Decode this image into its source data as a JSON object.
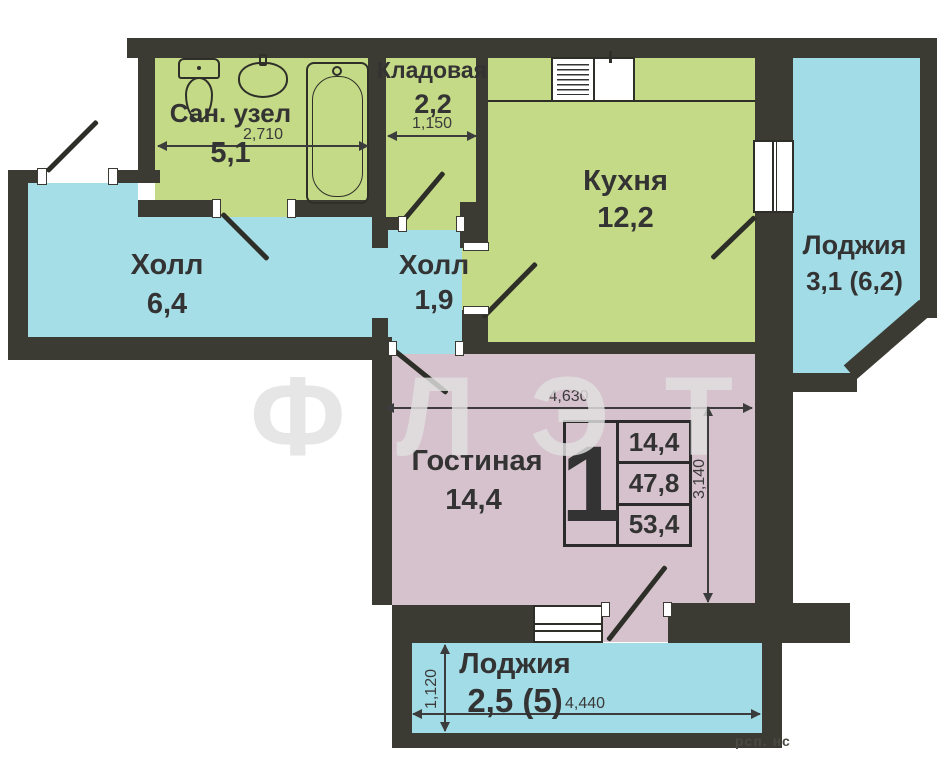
{
  "rooms": {
    "bathroom": {
      "name": "Сан. узел",
      "area": "5,1"
    },
    "storage": {
      "name": "Кладовая",
      "area": "2,2"
    },
    "kitchen": {
      "name": "Кухня",
      "area": "12,2"
    },
    "hall_big": {
      "name": "Холл",
      "area": "6,4"
    },
    "hall_small": {
      "name": "Холл",
      "area": "1,9"
    },
    "loggia_right": {
      "name": "Лоджия",
      "area": "3,1 (6,2)"
    },
    "living": {
      "name": "Гостиная",
      "area": "14,4"
    },
    "loggia_bottom": {
      "name": "Лоджия",
      "area": "2,5 (5)"
    }
  },
  "dims": {
    "bathroom_width": "2,710",
    "storage_width": "1,150",
    "living_width": "4,630",
    "living_depth": "3,140",
    "loggia_depth": "1,120",
    "loggia_width": "4,440"
  },
  "legend": {
    "rooms_count": "1",
    "living_area": "14,4",
    "apartment_area": "47,8",
    "total_area": "53,4"
  },
  "watermark": {
    "text": "ФЛЭТ",
    "corner": "рсп. нс"
  },
  "colors": {
    "wall": "#3b3b33",
    "wet_rooms": "#c4da86",
    "halls": "#a6dee7",
    "living": "#d6c2cc",
    "loggia": "#a2dce6"
  }
}
